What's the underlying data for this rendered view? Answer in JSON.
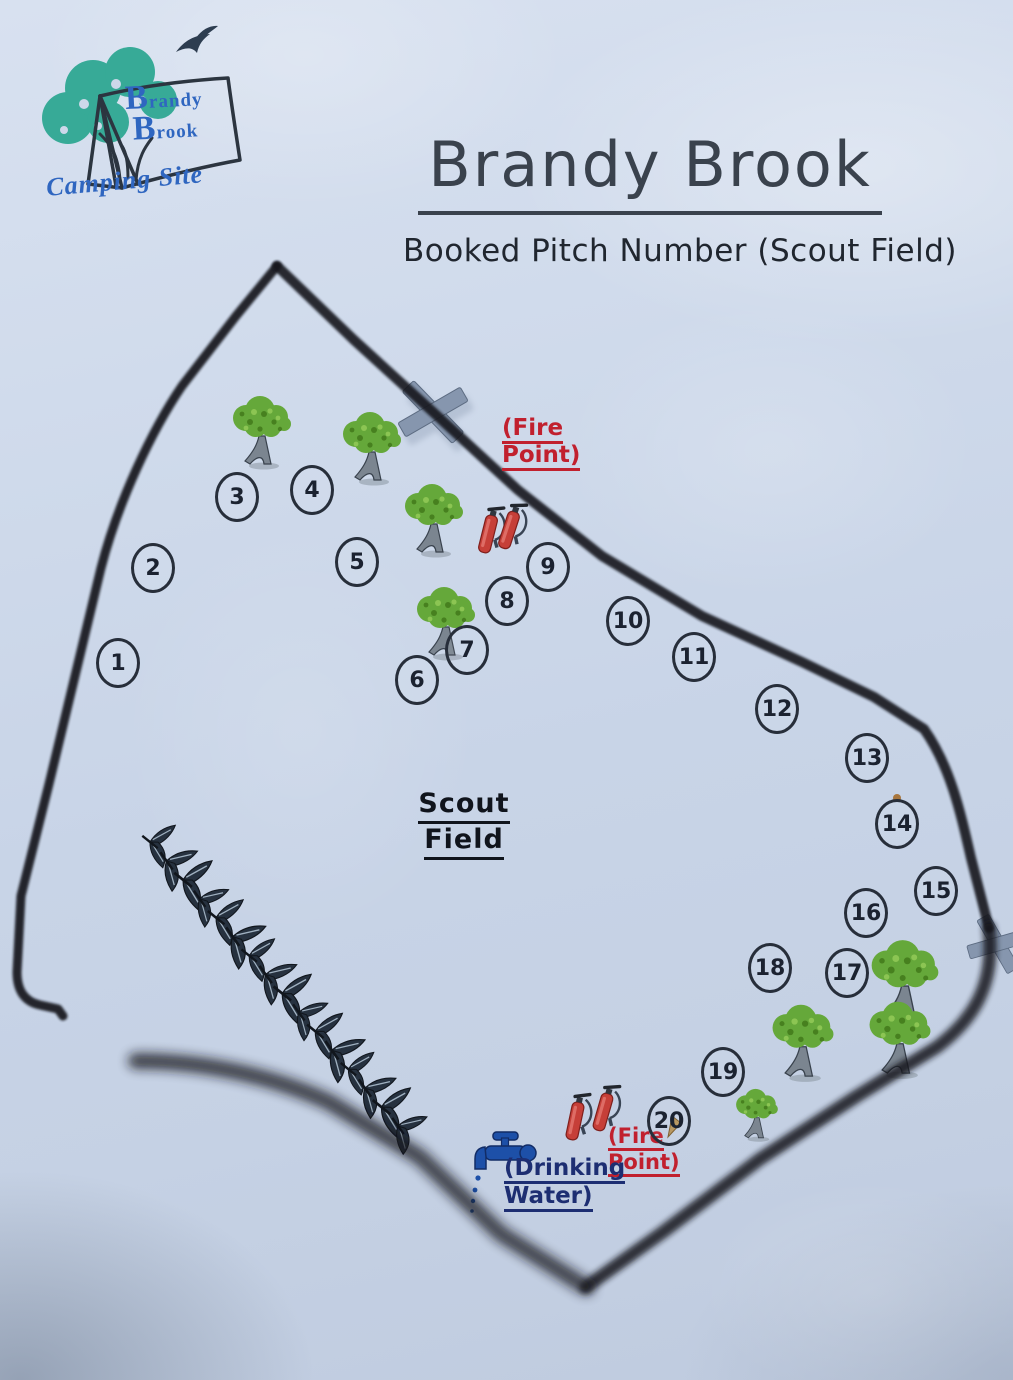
{
  "logo": {
    "brand_word1": "Brandy",
    "brand_word2": "Brook",
    "caption": "Camping Site"
  },
  "header": {
    "title": "Brandy Brook",
    "subtitle": "Booked Pitch Number (Scout Field)"
  },
  "map": {
    "field_label": [
      "Scout",
      "Field"
    ],
    "labels": {
      "fire_point_top": [
        "(Fire",
        "Point)"
      ],
      "fire_point_bottom": [
        "(Fire",
        "Point)"
      ],
      "drinking_water": [
        "(Drinking",
        "Water)"
      ]
    },
    "pitches": [
      {
        "n": "1",
        "x": 118,
        "y": 663
      },
      {
        "n": "2",
        "x": 153,
        "y": 568
      },
      {
        "n": "3",
        "x": 237,
        "y": 497
      },
      {
        "n": "4",
        "x": 312,
        "y": 490
      },
      {
        "n": "5",
        "x": 357,
        "y": 562
      },
      {
        "n": "6",
        "x": 417,
        "y": 680
      },
      {
        "n": "7",
        "x": 467,
        "y": 650
      },
      {
        "n": "8",
        "x": 507,
        "y": 601
      },
      {
        "n": "9",
        "x": 548,
        "y": 567
      },
      {
        "n": "10",
        "x": 628,
        "y": 621
      },
      {
        "n": "11",
        "x": 694,
        "y": 657
      },
      {
        "n": "12",
        "x": 777,
        "y": 709
      },
      {
        "n": "13",
        "x": 867,
        "y": 758
      },
      {
        "n": "14",
        "x": 897,
        "y": 824
      },
      {
        "n": "15",
        "x": 936,
        "y": 891
      },
      {
        "n": "16",
        "x": 866,
        "y": 913
      },
      {
        "n": "17",
        "x": 847,
        "y": 973
      },
      {
        "n": "18",
        "x": 770,
        "y": 968
      },
      {
        "n": "19",
        "x": 723,
        "y": 1072
      },
      {
        "n": "20",
        "x": 669,
        "y": 1121
      }
    ],
    "trees": [
      {
        "x": 262,
        "y": 442,
        "s": 1
      },
      {
        "x": 372,
        "y": 458,
        "s": 1
      },
      {
        "x": 434,
        "y": 530,
        "s": 1
      },
      {
        "x": 446,
        "y": 633,
        "s": 1
      },
      {
        "x": 905,
        "y": 993,
        "s": 1.15
      },
      {
        "x": 803,
        "y": 1053,
        "s": 1.05
      },
      {
        "x": 900,
        "y": 1050,
        "s": 1.05
      },
      {
        "x": 757,
        "y": 1122,
        "s": 0.72
      }
    ],
    "hedge": {
      "x1": 150,
      "y1": 842,
      "x2": 398,
      "y2": 1126,
      "count": 16
    }
  },
  "icons": {
    "logo_tree": "teal-scribble-tree",
    "logo_tent": "tent-outline",
    "bird": "flying-gull-silhouette",
    "tree": "green-broadleaf-tree",
    "fire_extinguisher": "red-fire-extinguisher",
    "tap": "blue-water-tap",
    "gate_marker": "grey-crossed-planks-x",
    "hedge_leaf": "dark-leaf-pair"
  },
  "colors": {
    "paper": "#ccd7e9",
    "ink": "#1d2430",
    "title_ink": "#3a424d",
    "boundary": "#12171f",
    "fire_red": "#c1202e",
    "water_navy": "#1d2e72",
    "logo_blue": "#2f66c0",
    "logo_teal": "#2fa893",
    "tree_green": "#65a83a",
    "marker_grey": "#8696ae",
    "hedge_dark": "#26313f"
  }
}
